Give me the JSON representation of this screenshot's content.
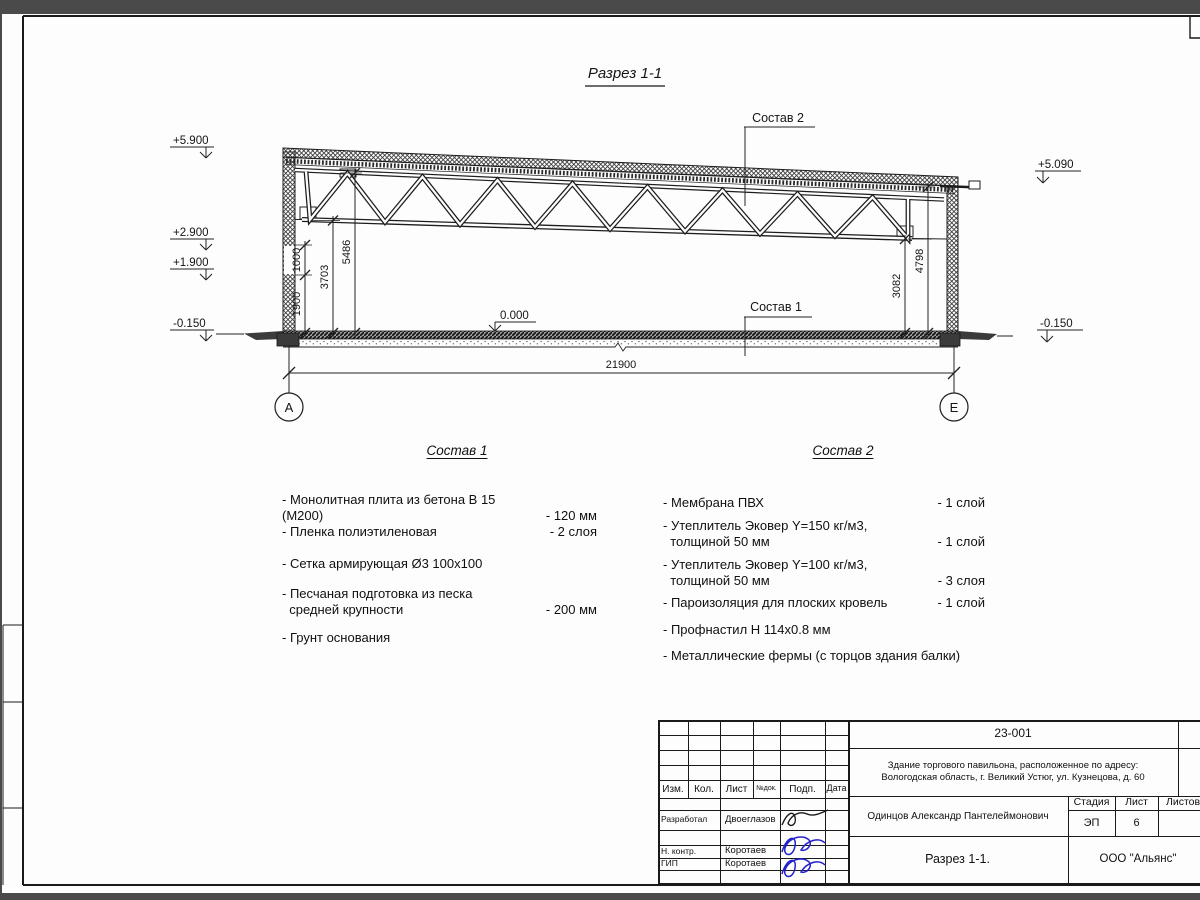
{
  "drawing": {
    "title": "Разрез 1-1",
    "labels": {
      "sostav1": "Состав 1",
      "sostav2": "Состав 2",
      "zero_mark": "0.000"
    },
    "elevations": {
      "left": [
        "+5.900",
        "+2.900",
        "+1.900",
        "-0.150"
      ],
      "right_top": "+5.090",
      "right_bottom": "-0.150"
    },
    "dimensions": {
      "overall": "21900",
      "d1000": "1000",
      "d1900": "1900",
      "d3703": "3703",
      "d5486": "5486",
      "d3082": "3082",
      "d4798": "4798"
    },
    "axes": {
      "left": "А",
      "right": "Е"
    }
  },
  "materials1": {
    "title": "Состав 1",
    "items": [
      {
        "text": "- Монолитная плита из бетона В 15 (М200)",
        "value": "- 120 мм"
      },
      {
        "text": "- Пленка полиэтиленовая",
        "value": "-  2 слоя"
      },
      {
        "text": "- Сетка армирующая Ø3 100х100",
        "value": ""
      },
      {
        "text": "- Песчаная подготовка из песка\n  средней крупности",
        "value": "- 200 мм"
      },
      {
        "text": "- Грунт основания",
        "value": ""
      }
    ]
  },
  "materials2": {
    "title": "Состав 2",
    "items": [
      {
        "text": "- Мембрана ПВХ",
        "value": "- 1 слой"
      },
      {
        "text": "- Утеплитель Эковер Y=150 кг/м3,\n  толщиной 50 мм",
        "value": "- 1 слой"
      },
      {
        "text": "- Утеплитель Эковер Y=100 кг/м3,\n  толщиной 50 мм",
        "value": "- 3 слоя"
      },
      {
        "text": "- Пароизоляция для плоских кровель",
        "value": "- 1 слой"
      },
      {
        "text": "- Профнастил Н 114х0.8 мм",
        "value": ""
      },
      {
        "text": "- Металлические фермы (с торцов здания балки)",
        "value": ""
      }
    ]
  },
  "title_block": {
    "doc_number": "23-001",
    "object_line1": "Здание торгового павильона, расположенное по адресу:",
    "object_line2": "Вологодская область, г. Великий Устюг, ул. Кузнецова, д. 60",
    "client": "Одинцов Александр Пантелеймонович",
    "cols": {
      "izm": "Изм.",
      "kol": "Кол.",
      "list": "Лист",
      "ndoc": "№док.",
      "podp": "Подп.",
      "data": "Дата"
    },
    "stage_label": "Стадия",
    "sheet_label": "Лист",
    "sheets_label": "Листов",
    "stage": "ЭП",
    "sheet": "6",
    "rows": [
      {
        "role": "Разработал",
        "name": "Двоеглазов"
      },
      {
        "role": "Н. контр.",
        "name": "Коротаев"
      },
      {
        "role": "ГИП",
        "name": "Коротаев"
      }
    ],
    "view_name": "Разрез 1-1.",
    "company": "ООО \"Альянс\""
  }
}
